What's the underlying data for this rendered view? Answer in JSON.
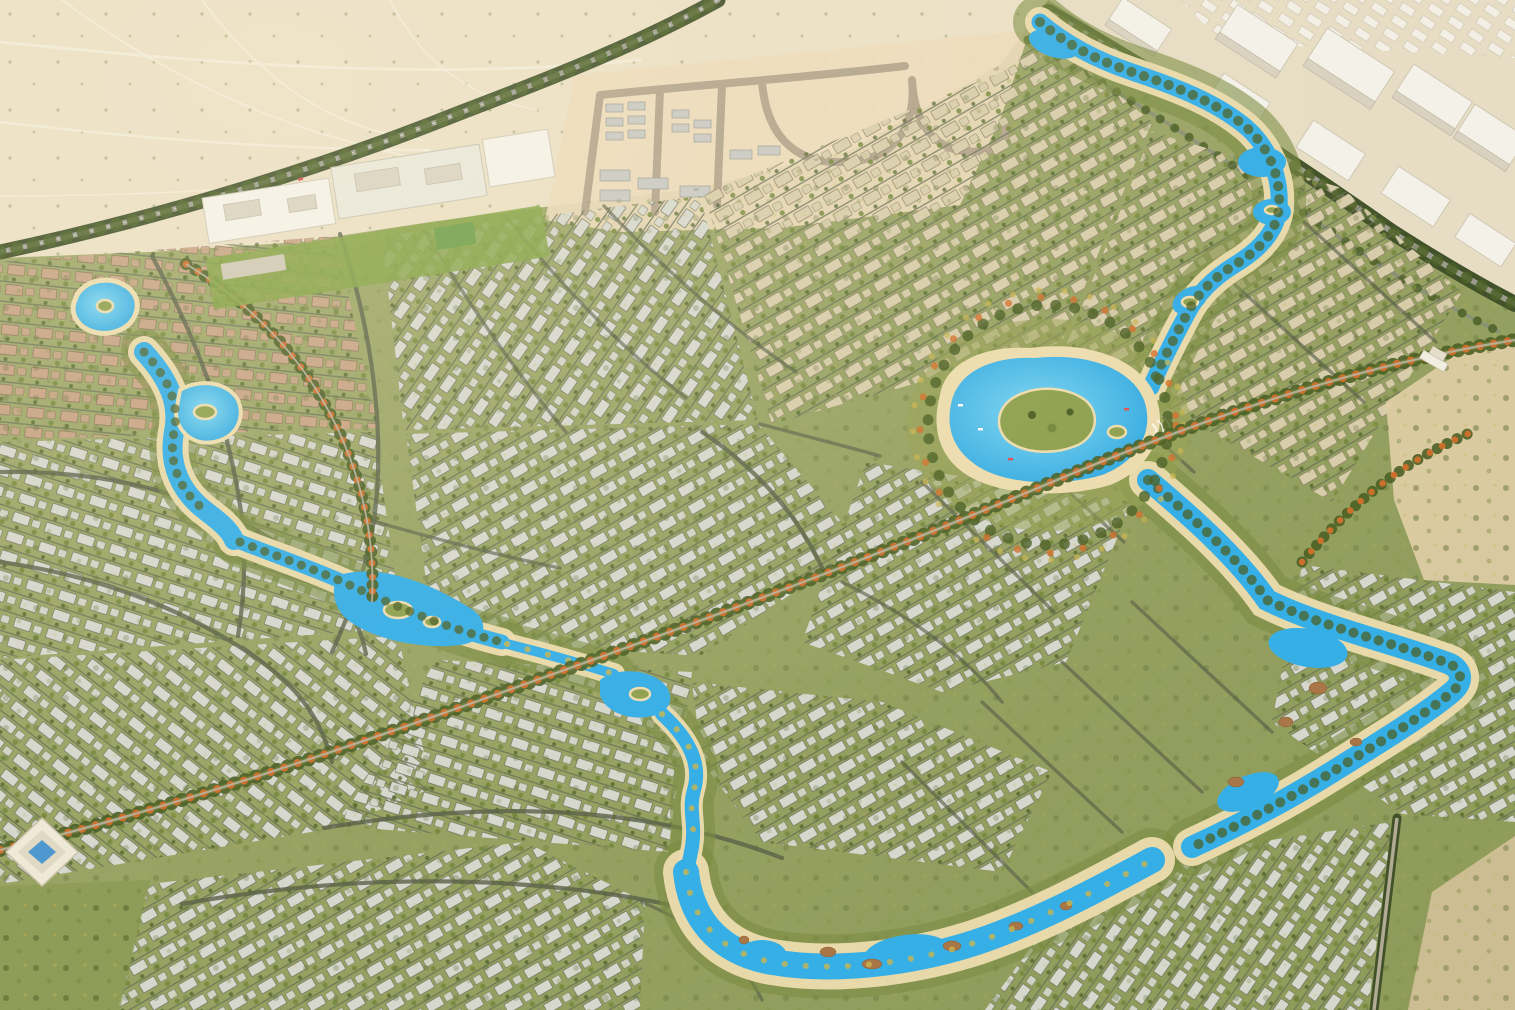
{
  "meta": {
    "title": "Aerial 3D render of a desert master-planned lagoon villa community",
    "image_type": "photorealistic-aerial-render",
    "width_px": 1515,
    "height_px": 1010
  },
  "scene": {
    "regions": [
      {
        "id": "desert-northwest",
        "label": "Undeveloped sandy desert with faint vehicle tracks and scattered shrubs"
      },
      {
        "id": "construction-site",
        "label": "Graded plot under construction with looping access roads and rows of site cabins"
      },
      {
        "id": "existing-city",
        "label": "Existing city: white mid-rise blocks along a tree-lined highway (top right)"
      },
      {
        "id": "school-campus",
        "label": "Low white campus/community complex with lawns (upper left)"
      },
      {
        "id": "villa-districts",
        "label": "Dense curved rows of villas with gray, tan and terracotta roofs along tree-lined streets"
      },
      {
        "id": "central-lagoon",
        "label": "Large turquoise central lagoon with palm island and sandy beach"
      },
      {
        "id": "lagoon-rivers",
        "label": "Winding crystal lagoon river channels threading between districts"
      },
      {
        "id": "waterpark",
        "label": "Water-park style river with brown rock islands along the bottom"
      },
      {
        "id": "boulevards",
        "label": "Boulevards lined with orange flowering trees"
      }
    ],
    "landmarks": [
      {
        "id": "ziggurat-pavilion",
        "label": "Stepped white pavilion with blue pool (left edge)"
      },
      {
        "id": "entrance-gate",
        "label": "Small white entrance gate building (right edge)"
      }
    ],
    "water_features_count": 8,
    "text_on_screen": ""
  },
  "colors": {
    "dev_base": "#98a263",
    "dev_base_dark": "#8d9a58",
    "desert_sand": "#ebdfc4",
    "desert_track": "#f4eedd",
    "construction_sand": "#ecdaba",
    "construction_road": "#b3a48c",
    "city_ground": "#e7ddc4",
    "building_white": "#f4f1e8",
    "building_shadow": "#d9d2c0",
    "roof_gray": "#d6d7cd",
    "roof_tan": "#d8cdab",
    "roof_brown": "#c7a485",
    "street": "#6a7158",
    "road_dark": "#5a6149",
    "hwy_green": "#41512a",
    "hwy_asphalt": "#9c9c8e",
    "tree_dark": "#4c6026",
    "tree_mid": "#75873c",
    "tree_band": "#7c8c42",
    "tree_yellow": "#c9b550",
    "tree_orange": "#d2702c",
    "water_main": "#36aee6",
    "water_light": "#7fd7f2",
    "beach_sand": "#ecdcae",
    "island_green": "#8fa04f",
    "rock_brown": "#a87647",
    "lawn_green": "#86a446",
    "pool_blue": "#4f97cf",
    "scrub_sand": "#cdbd92"
  }
}
